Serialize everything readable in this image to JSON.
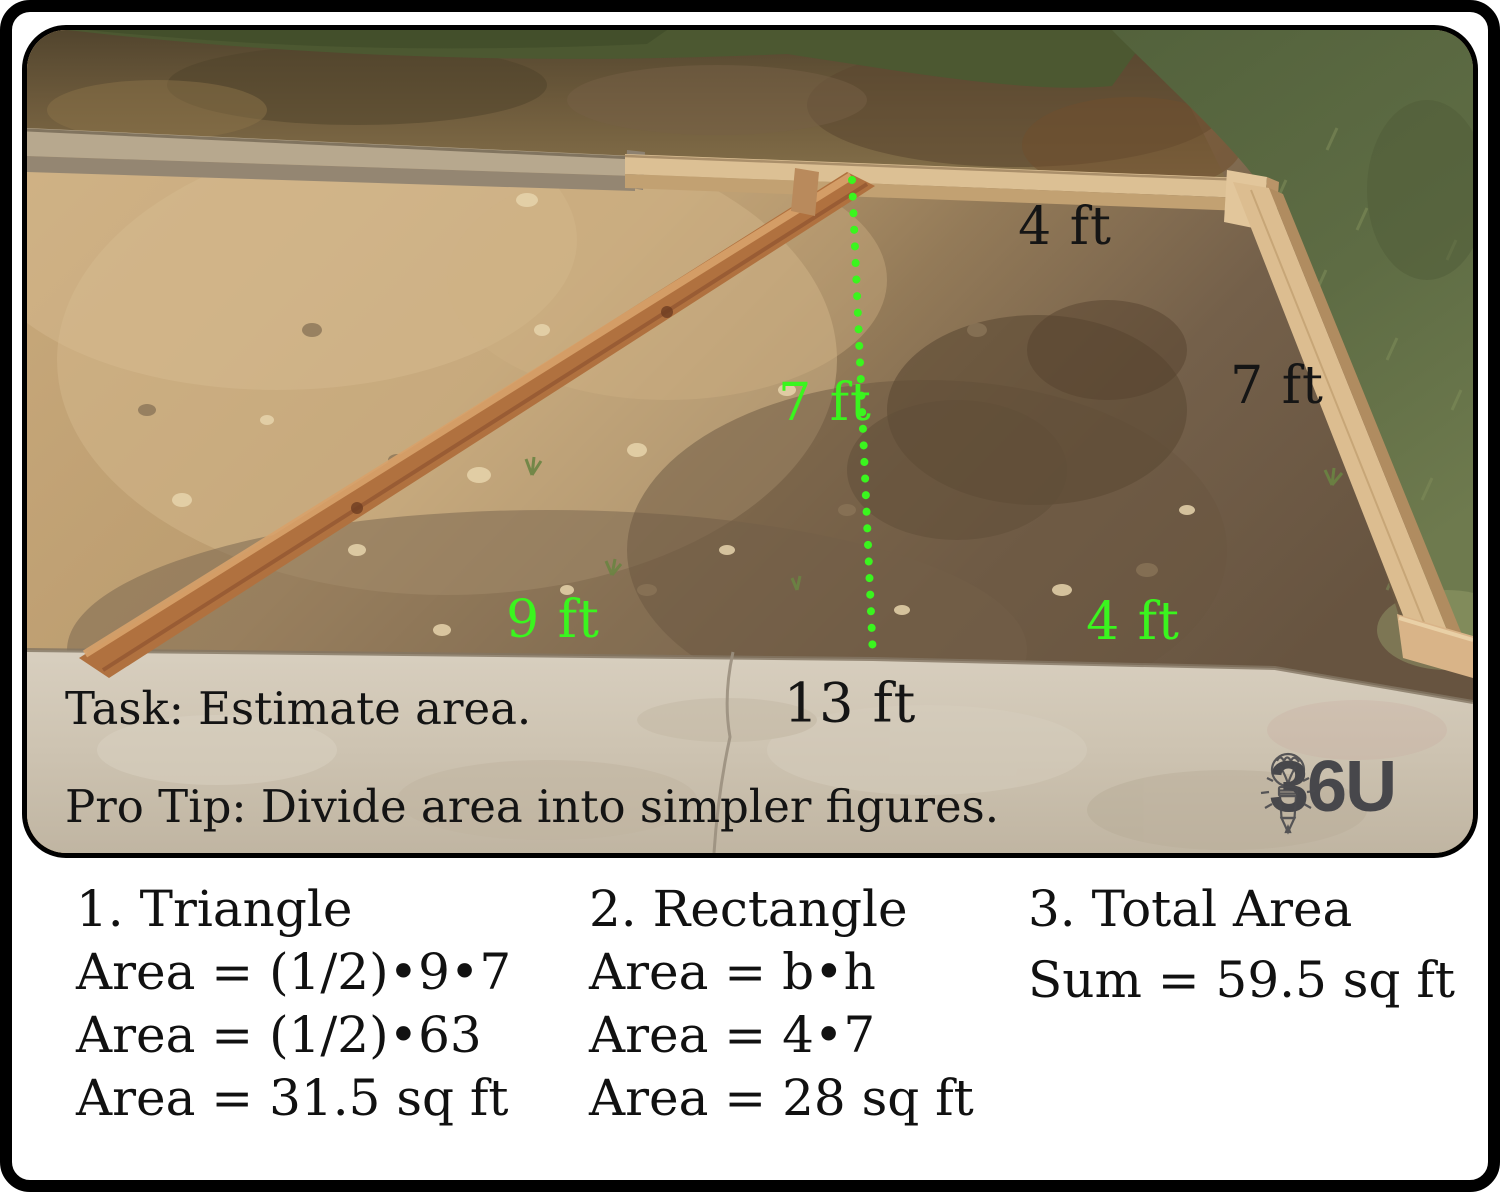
{
  "photo": {
    "description": "excavated garden bed framed with wooden boards, concrete sidewalk in front",
    "labels": {
      "top_width": {
        "text": "4 ft",
        "color": "black"
      },
      "divider_height": {
        "text": "7 ft",
        "color": "green"
      },
      "right_side": {
        "text": "7 ft",
        "color": "black"
      },
      "triangle_base": {
        "text": "9 ft",
        "color": "green"
      },
      "rectangle_base": {
        "text": "4 ft",
        "color": "green"
      },
      "total_base": {
        "text": "13 ft",
        "color": "black"
      }
    },
    "task_line": "Task: Estimate area.",
    "protip_line": "Pro Tip: Divide area into simpler figures.",
    "logo": {
      "text": "36U",
      "icon": "lightbulb-pencil-icon"
    }
  },
  "solution": {
    "columns": [
      {
        "heading": "1. Triangle",
        "lines": [
          "Area = (1/2)•9•7",
          "Area = (1/2)•63",
          "Area = 31.5 sq ft"
        ]
      },
      {
        "heading": "2. Rectangle",
        "lines": [
          "Area = b•h",
          "Area = 4•7",
          "Area = 28 sq ft"
        ]
      },
      {
        "heading": "3. Total Area",
        "lines": [
          "Sum = 59.5 sq ft"
        ]
      }
    ]
  },
  "colors": {
    "annotation_green": "#3af51e",
    "text_black": "#141414",
    "logo_gray": "#47474b"
  }
}
